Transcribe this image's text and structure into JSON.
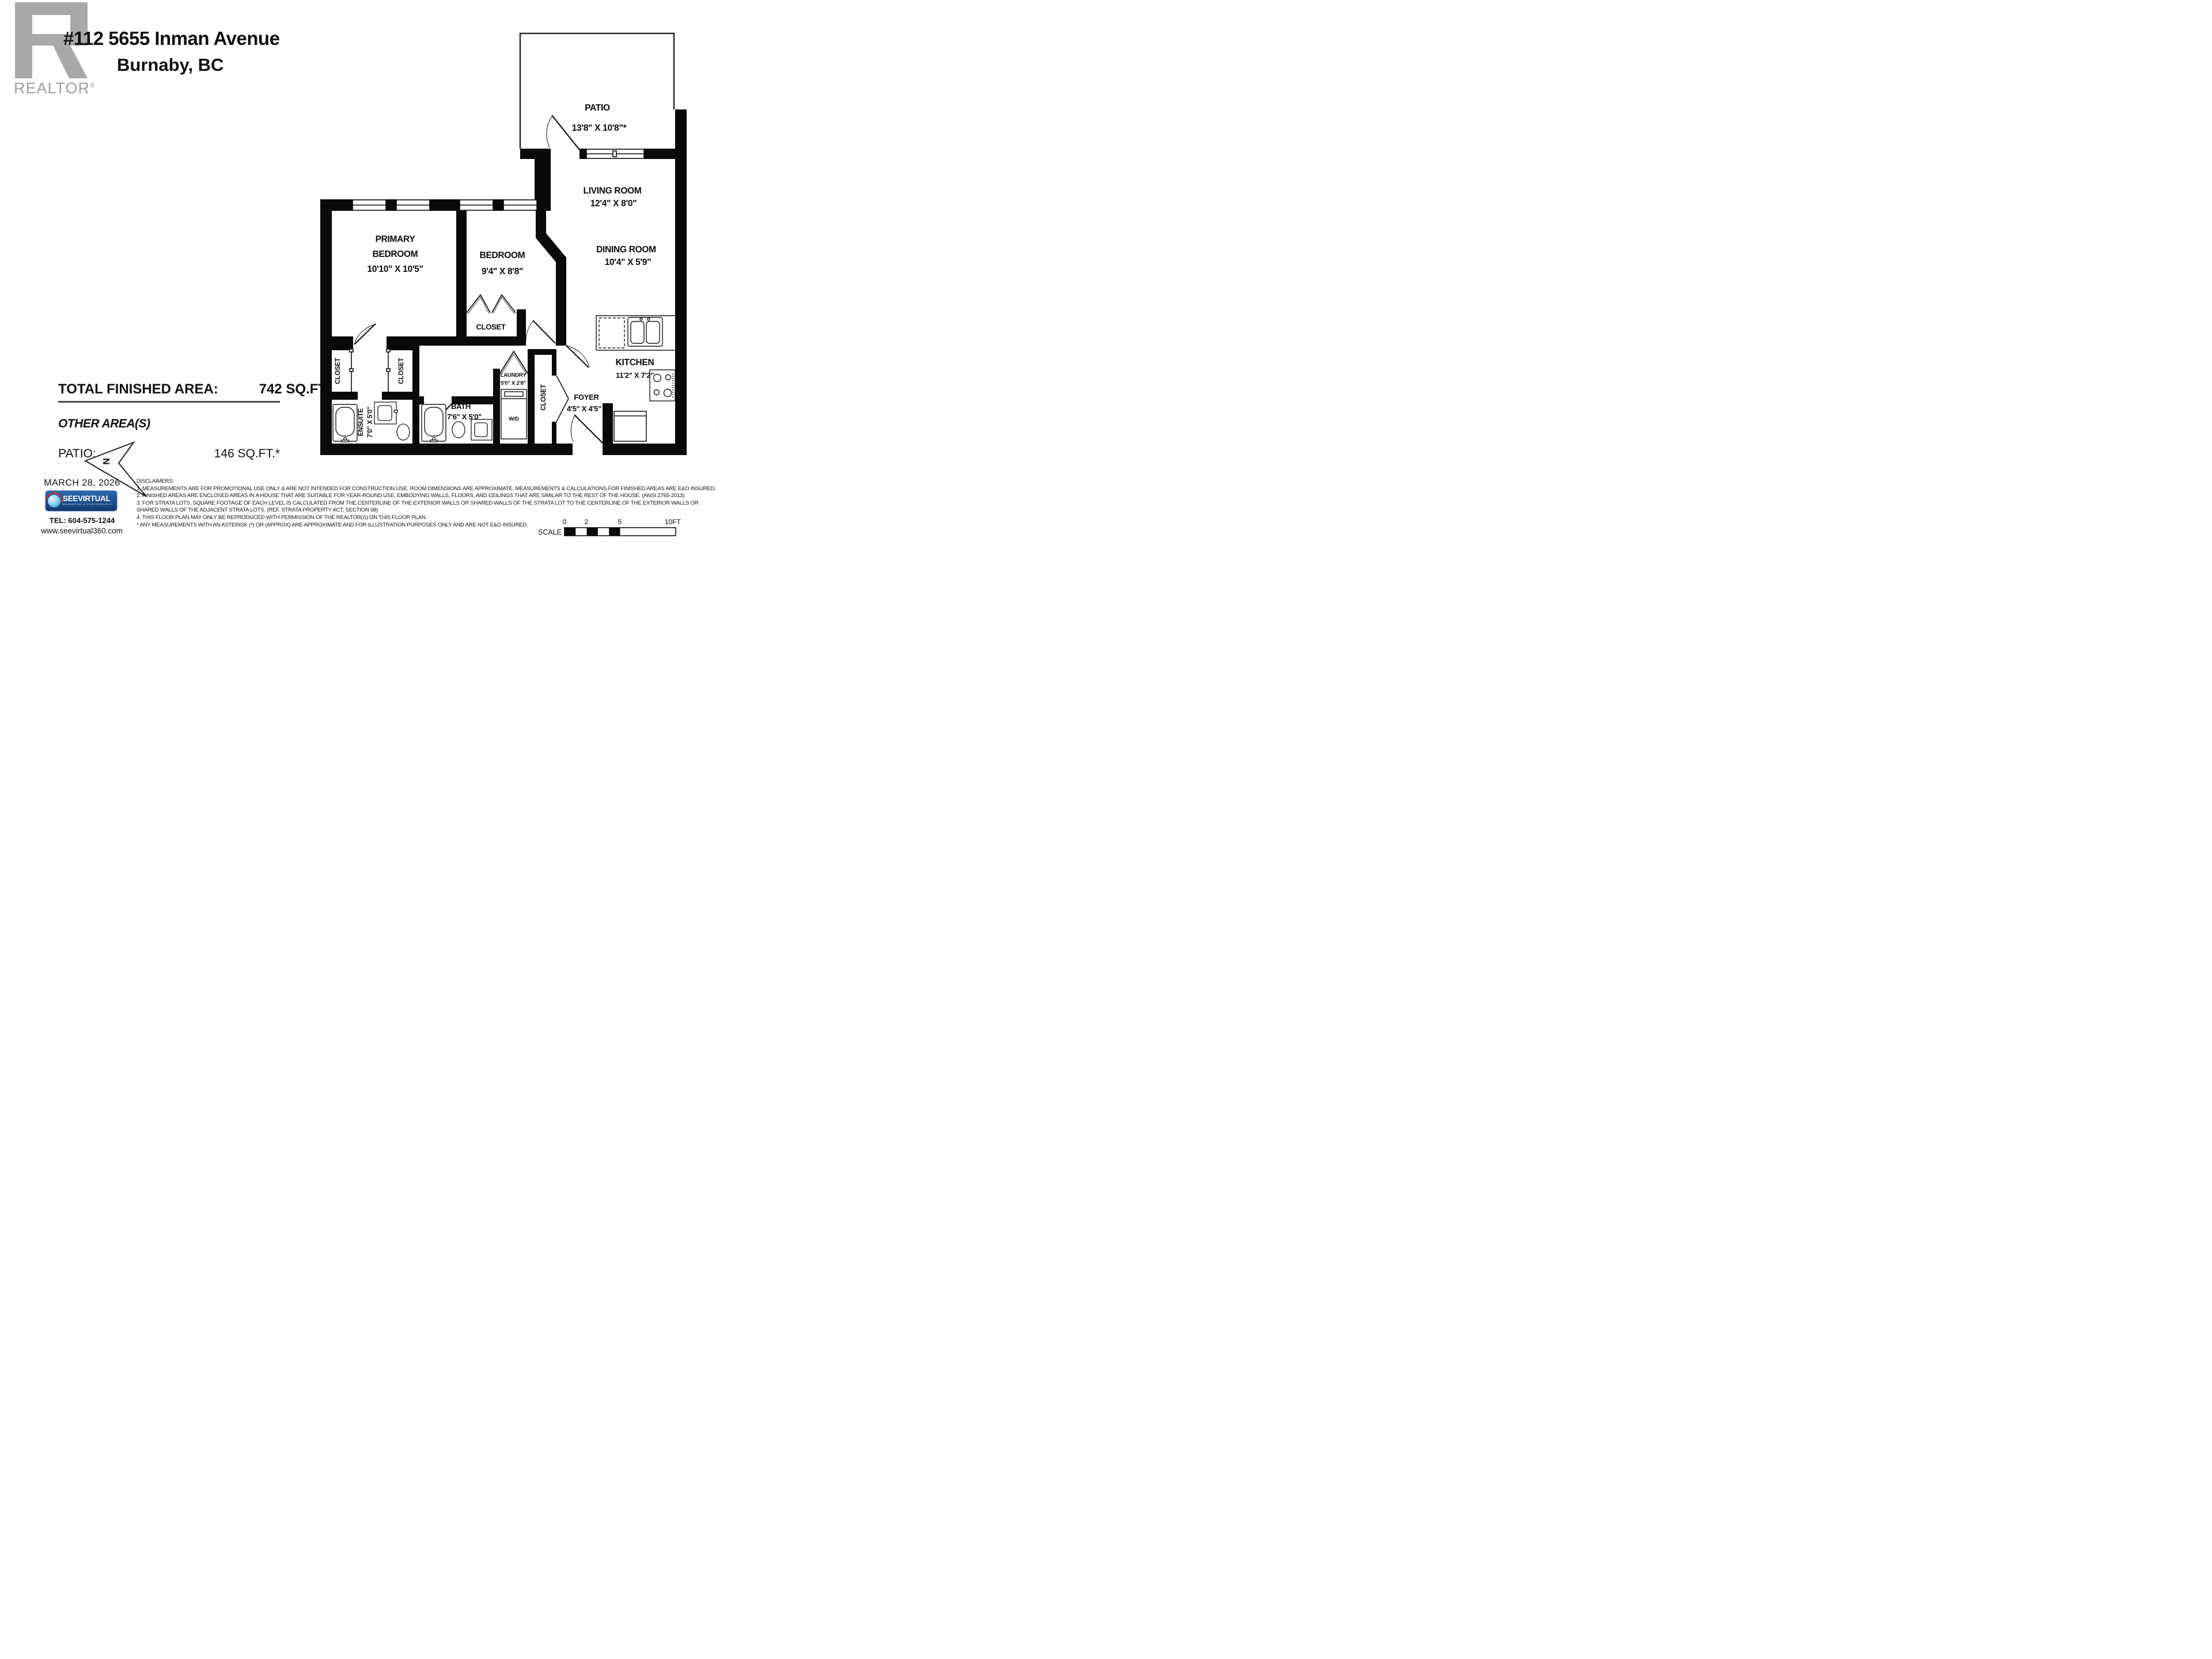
{
  "header": {
    "logo_brand": "REALTOR",
    "logo_reg": "®",
    "address_line1": "#112 5655 Inman Avenue",
    "address_line2": "Burnaby, BC"
  },
  "area_summary": {
    "total_label": "TOTAL FINISHED AREA:",
    "total_value": "742 SQ.FT.",
    "other_label": "OTHER AREA(S)",
    "patio_label": "PATIO:",
    "patio_value": "146 SQ.FT.*"
  },
  "rooms": {
    "patio": {
      "name": "PATIO",
      "dims": "13'8\" X 10'8\"*"
    },
    "living": {
      "name": "LIVING ROOM",
      "dims": "12'4\" X 8'0\""
    },
    "dining": {
      "name": "DINING ROOM",
      "dims": "10'4\" X 5'9\""
    },
    "primary": {
      "name1": "PRIMARY",
      "name2": "BEDROOM",
      "dims": "10'10\" X 10'5\""
    },
    "bedroom": {
      "name": "BEDROOM",
      "dims": "9'4\" X 8'8\""
    },
    "kitchen": {
      "name": "KITCHEN",
      "dims": "11'2\" X 7'2\""
    },
    "foyer": {
      "name": "FOYER",
      "dims": "4'5\" X 4'5\""
    },
    "laundry": {
      "name": "LAUNDRY",
      "dims": "5'0\" X 2'8\"",
      "appliance": "W/D"
    },
    "bath": {
      "name": "BATH",
      "dims": "7'6\" X 5'0\""
    },
    "ensuite": {
      "name": "ENSUITE",
      "dims": "7'0\" X 5'0\""
    },
    "closet_label": "CLOSET",
    "north_letter": "N"
  },
  "footer": {
    "date": "MARCH 28, 2026",
    "logo_main": "SEEVIRTUAL",
    "logo_sub": "MARKETING & PHOTOGRAPHY",
    "tel": "TEL: 604-575-1244",
    "website": "www.seevirtual360.com"
  },
  "disclaimers": {
    "title": "DISCLAIMERS:",
    "lines": [
      "1. MEASUREMENTS ARE FOR PROMOTIONAL USE ONLY & ARE NOT INTENDED FOR CONSTRUCTION USE. ROOM DIMENSIONS ARE APPROXIMATE. MEASUREMENTS & CALCULATIONS FOR FINISHED AREAS ARE E&O INSURED.",
      "2. FINISHED AREAS ARE ENCLOSED AREAS IN A HOUSE THAT ARE SUITABLE FOR YEAR-ROUND USE, EMBODYING WALLS, FLOORS, AND CEILINGS THAT ARE SIMILAR TO THE REST OF THE HOUSE. (ANSI Z765-2013)",
      "3. FOR STRATA LOTS, SQUARE FOOTAGE OF EACH LEVEL IS CALCULATED FROM THE CENTERLINE OF THE EXTERIOR WALLS OR SHARED WALLS OF THE STRATA LOT TO THE CENTERLINE OF THE EXTERIOR WALLS OR",
      "SHARED WALLS OF THE ADJACENT STRATA LOTS. (REF. STRATA PROPERTY ACT, SECTION 68)",
      "4. THIS FLOOR PLAN MAY ONLY BE REPRODUCED WITH PERMISSION OF THE REALTOR(S) ON THIS FLOOR PLAN.",
      "* ANY MEASUREMENTS WITH AN ASTERISK (*) OR (APPROX) ARE APPROXIMATE AND FOR ILLUSTRATION PURPOSES ONLY AND ARE NOT E&O INSURED."
    ]
  },
  "scale_bar": {
    "label": "SCALE",
    "t0": "0",
    "t2": "2",
    "t5": "5",
    "t10": "10FT"
  },
  "colors": {
    "wall": "#0a0a0a",
    "logo_grey": "#a9a9a9",
    "brand_blue": "#12386d",
    "swoosh_red": "#d0342c"
  }
}
